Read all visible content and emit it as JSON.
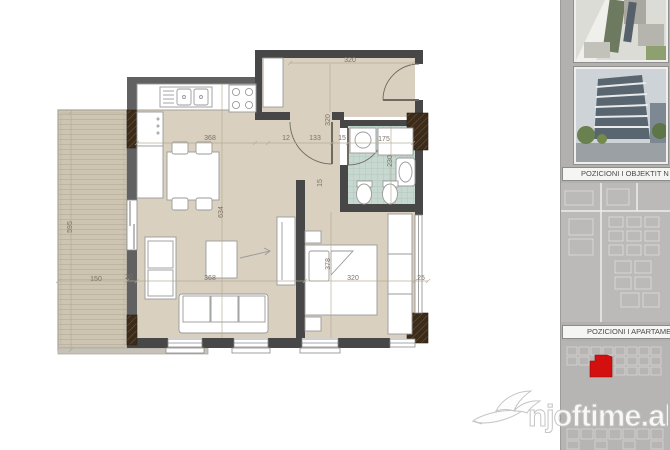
{
  "colors": {
    "floor": "#d9d0bf",
    "terrace": "#cdc5b2",
    "terraceLine": "#b8af9c",
    "tile": "#c7d8d1",
    "tileLine": "#a9c2ba",
    "wall": "#474747",
    "wallLight": "#616161",
    "hatch": "#3a2b1b",
    "hatchLine": "#6b5130",
    "furnStroke": "#9a9a9a",
    "dimText": "#7b7265",
    "dimLine": "#b3a995",
    "sidebarBg": "#b2b1af",
    "highlight": "#d40f0f",
    "watermarkStroke": "#c2c2c2"
  },
  "floor_plan": {
    "dimensions": [
      {
        "label": "320",
        "x": 350,
        "y": 62,
        "rot": 0
      },
      {
        "label": "320",
        "x": 330,
        "y": 120,
        "rot": -90
      },
      {
        "label": "368",
        "x": 210,
        "y": 140,
        "rot": 0
      },
      {
        "label": "12",
        "x": 286,
        "y": 140,
        "rot": 0
      },
      {
        "label": "133",
        "x": 315,
        "y": 140,
        "rot": 0
      },
      {
        "label": "15",
        "x": 342,
        "y": 140,
        "rot": 0
      },
      {
        "label": "175",
        "x": 384,
        "y": 141,
        "rot": 0
      },
      {
        "label": "230",
        "x": 392,
        "y": 161,
        "rot": -90
      },
      {
        "label": "15",
        "x": 322,
        "y": 183,
        "rot": -90
      },
      {
        "label": "634",
        "x": 223,
        "y": 212,
        "rot": -90
      },
      {
        "label": "595",
        "x": 72,
        "y": 227,
        "rot": -90
      },
      {
        "label": "150",
        "x": 96,
        "y": 281,
        "rot": 0
      },
      {
        "label": "20",
        "x": 129,
        "y": 279,
        "rot": 0
      },
      {
        "label": "368",
        "x": 210,
        "y": 280,
        "rot": 0
      },
      {
        "label": "378",
        "x": 330,
        "y": 264,
        "rot": -90
      },
      {
        "label": "320",
        "x": 353,
        "y": 280,
        "rot": 0
      },
      {
        "label": "25",
        "x": 421,
        "y": 280,
        "rot": 0
      }
    ]
  },
  "sidebar": {
    "labels": [
      {
        "text": "POZICIONI I OBJEKTIT N"
      },
      {
        "text": "POZICIONI I APARTAME"
      }
    ]
  },
  "watermark": {
    "text": "njoftime.al"
  }
}
